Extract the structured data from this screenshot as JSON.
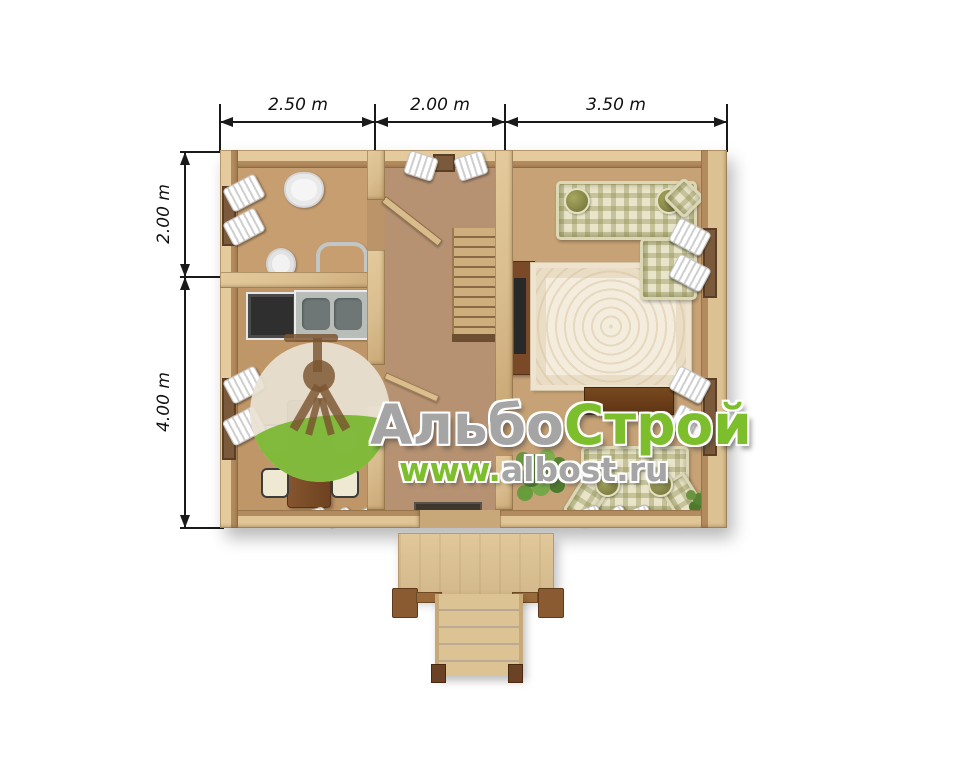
{
  "watermark": {
    "brand_part_1": "Альбо",
    "brand_part_2": "Строй",
    "url_part_1": "www.",
    "url_part_2": "albost.ru",
    "colors": {
      "green": "#7cbe2c",
      "silver": "#a5a5a5",
      "logo_top": "#e8e1d3",
      "logo_bottom": "#76b62b",
      "compass": "#7a5430"
    }
  },
  "dimensions": {
    "top": [
      {
        "label": "2.50 m"
      },
      {
        "label": "2.00 m"
      },
      {
        "label": "3.50 m"
      }
    ],
    "left": [
      {
        "label": "2.00 m"
      },
      {
        "label": "4.00 m"
      }
    ]
  },
  "plan": {
    "colors": {
      "wall": "#dcc193",
      "wall_shade": "#b28b5e",
      "floor_bathroom": "#c79e70",
      "floor_kitchen": "#bf9668",
      "floor_hall": "#b69272",
      "floor_living": "#c7a276",
      "porch": "#d9c193"
    },
    "rooms": [
      "bathroom",
      "kitchen",
      "hall",
      "living-room",
      "porch"
    ],
    "furniture_icons": [
      "wash-basin",
      "toilet",
      "towel-rail",
      "stove",
      "double-sink",
      "dining-table",
      "chair",
      "window-curtains",
      "staircase",
      "handrail",
      "door-leaf",
      "doormat",
      "corner-sofa",
      "round-pillow",
      "area-rug",
      "tv-cabinet",
      "console-table",
      "loveseat",
      "potted-plant",
      "slippers",
      "porch-steps"
    ]
  }
}
